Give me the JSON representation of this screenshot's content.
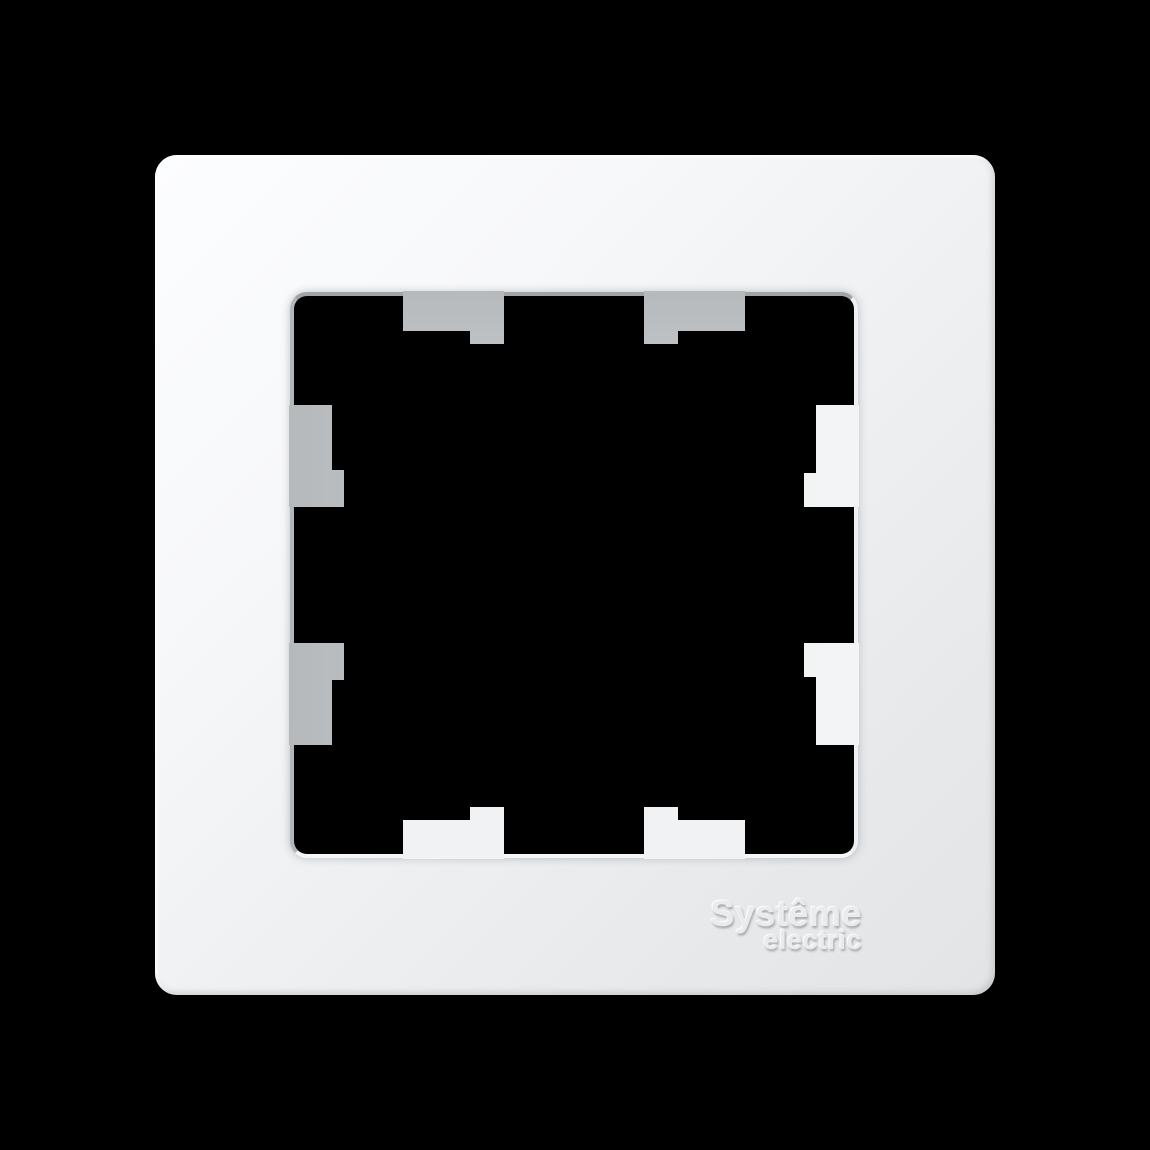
{
  "scene": {
    "background_color": "#000000",
    "object_name": "single-wall-switch-frame",
    "frame_color_light": "#fcfdfe",
    "frame_color_dark": "#e2e4e6",
    "tab_gray_color": "#c3c6c8",
    "tab_light_color": "#eff1f2",
    "opening_color": "#000000"
  },
  "logo": {
    "line1": "Systême",
    "line2": "electric",
    "color": "#e9ebed"
  }
}
